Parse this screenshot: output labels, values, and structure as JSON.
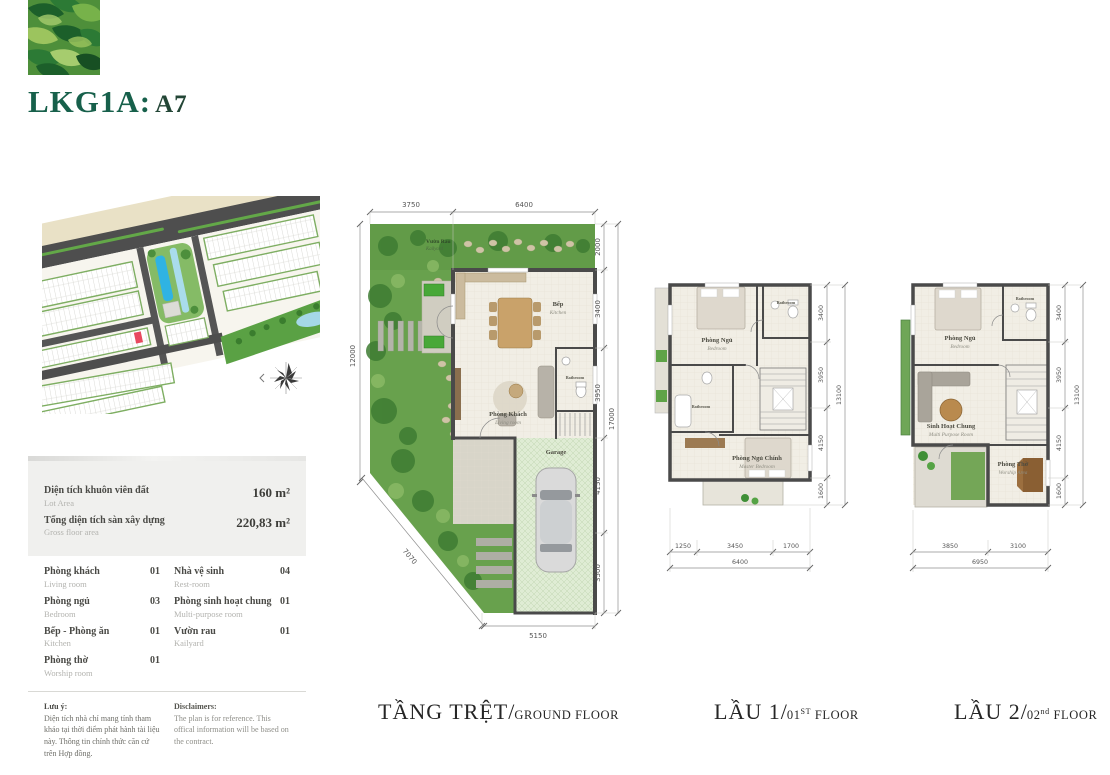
{
  "header": {
    "code": "LKG1A:",
    "unit": "A7"
  },
  "colors": {
    "accent_green": "#17604b",
    "wall": "#4a4a4a",
    "garden_green": "#68a14d",
    "pool_blue": "#2fb3e3",
    "highlight_lot_red": "#e8495f"
  },
  "info_panel": {
    "areas": [
      {
        "vi": "Diện tích khuôn viên đất",
        "en": "Lot Area",
        "value": "160 m²"
      },
      {
        "vi": "Tổng diện tích sàn xây dựng",
        "en": "Gross floor area",
        "value": "220,83 m²"
      }
    ],
    "rooms_left": [
      {
        "vi": "Phòng khách",
        "en": "Living room",
        "count": "01"
      },
      {
        "vi": "Phòng ngủ",
        "en": "Bedroom",
        "count": "03"
      },
      {
        "vi": "Bếp - Phòng ăn",
        "en": "Kitchen",
        "count": "01"
      },
      {
        "vi": "Phòng thờ",
        "en": "Worship room",
        "count": "01"
      }
    ],
    "rooms_right": [
      {
        "vi": "Nhà vệ sinh",
        "en": "Rest-room",
        "count": "04"
      },
      {
        "vi": "Phòng sinh hoạt chung",
        "en": "Multi-purpose room",
        "count": "01"
      },
      {
        "vi": "Vườn rau",
        "en": "Kailyard",
        "count": "01"
      }
    ],
    "note_vi": {
      "title": "Lưu ý:",
      "body": "Diện tích nhà chỉ mang tính tham khảo tại thời điểm phát hành tài liệu này. Thông tin chính thức căn cứ trên Hợp đồng."
    },
    "note_en": {
      "title": "Disclaimers:",
      "body": "The plan is for reference. This offical information will be based on the contract."
    }
  },
  "caption_sep": "/",
  "plans": {
    "ground": {
      "caption_vi": "TẦNG TRỆT",
      "caption_en_a": "GROUND FLOOR",
      "caption_sup": "",
      "caption_en_b": "",
      "dims_top": [
        "3750",
        "6400"
      ],
      "dim_left": "12000",
      "dims_right": [
        "2000",
        "3400",
        "3950",
        "4150",
        "3500"
      ],
      "dim_right_total": "17000",
      "dim_bottom": "5150",
      "dim_diagonal": "7070",
      "rooms": {
        "garden": {
          "vi": "Vườn Rau",
          "en": "Kailyard"
        },
        "kitchen": {
          "vi": "Bếp",
          "en": "Kitchen"
        },
        "living": {
          "vi": "Phòng Khách",
          "en": "Living room"
        },
        "bathroom": {
          "en": "Bathroom"
        },
        "garage": {
          "en": "Garage"
        }
      }
    },
    "floor1": {
      "caption_vi": "LẦU 1",
      "caption_en_a": "01",
      "caption_sup": "ST",
      "caption_en_b": " FLOOR",
      "dims_right": [
        "3400",
        "3950",
        "4150",
        "1600"
      ],
      "dim_right_total": "13100",
      "dims_bottom": [
        "1250",
        "3450",
        "1700"
      ],
      "dim_bottom_total": "6400",
      "rooms": {
        "bedroom": {
          "vi": "Phòng Ngủ",
          "en": "Bedroom"
        },
        "bathroom_top": {
          "en": "Bathroom"
        },
        "bathroom_mid": {
          "en": "Bathroom"
        },
        "master": {
          "vi": "Phòng Ngủ Chính",
          "en": "Master Bedroom"
        }
      }
    },
    "floor2": {
      "caption_vi": "LẦU 2",
      "caption_en_a": "02",
      "caption_sup": "nd",
      "caption_en_b": " FLOOR",
      "dims_right": [
        "3400",
        "3950",
        "4150",
        "1600"
      ],
      "dim_right_total": "13100",
      "dims_bottom": [
        "3850",
        "3100"
      ],
      "dim_bottom_total": "6950",
      "rooms": {
        "bedroom": {
          "vi": "Phòng Ngủ",
          "en": "Bedroom"
        },
        "bathroom": {
          "en": "Bathroom"
        },
        "multi": {
          "vi": "Sinh Hoạt Chung",
          "en": "Multi Purpose Room"
        },
        "worship": {
          "vi": "Phòng Thờ",
          "en": "Worship Area"
        }
      }
    }
  }
}
